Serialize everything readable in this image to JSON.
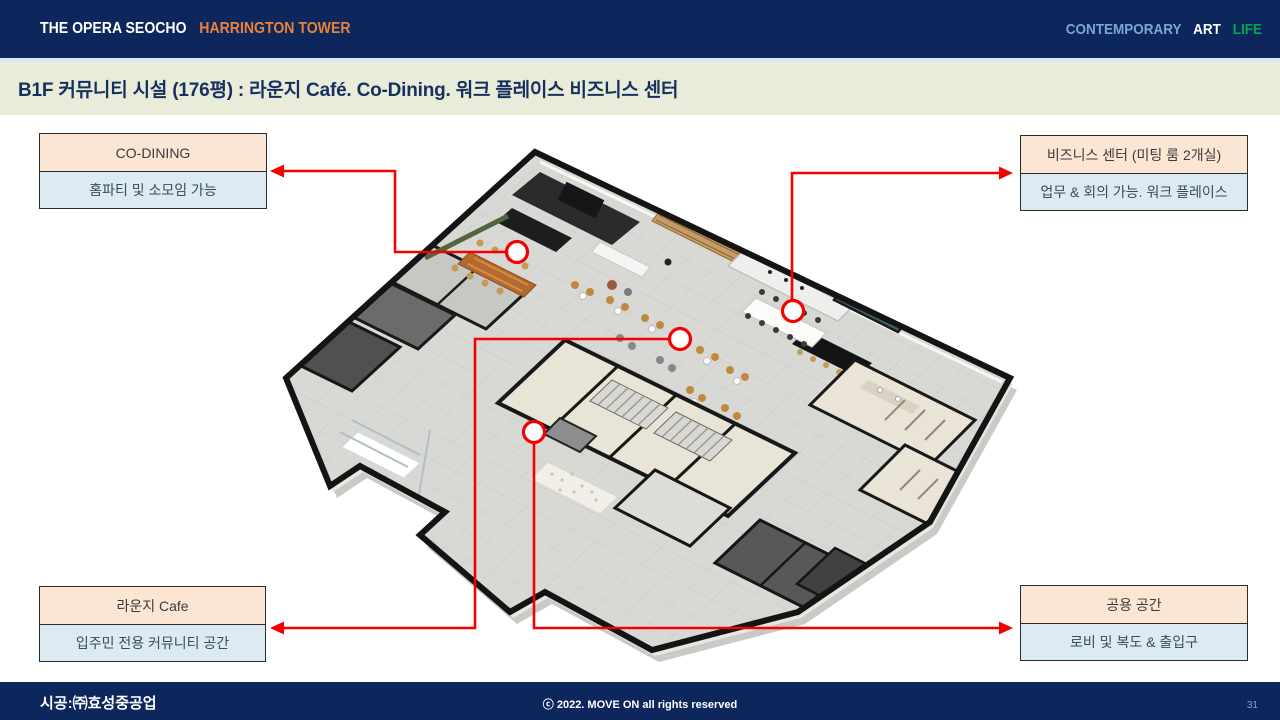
{
  "header": {
    "brand_primary": "THE OPERA SEOCHO",
    "brand_secondary": "HARRINGTON TOWER",
    "tagline_1": "CONTEMPORARY",
    "tagline_2": "ART",
    "tagline_3": "LIFE"
  },
  "title": {
    "text": "B1F 커뮤니티 시설 (176평) : 라운지 Café. Co-Dining. 워크 플레이스 비즈니스 센터"
  },
  "callouts": {
    "co_dining": {
      "title": "CO-DINING",
      "desc": "홈파티 및 소모임 가능"
    },
    "business": {
      "title": "비즈니스 센터 (미팅 룸 2개실)",
      "desc": "업무 & 회의 가능. 워크 플레이스"
    },
    "lounge": {
      "title": "라운지 Cafe",
      "desc": "입주민 전용 커뮤니티 공간"
    },
    "common": {
      "title": "공용 공간",
      "desc": "로비 및 복도 & 출입구"
    }
  },
  "footer": {
    "builder": "시공:㈜효성중공업",
    "copyright": "ⓒ 2022. MOVE ON all rights reserved",
    "page_number": "31"
  },
  "colors": {
    "navy": "#0d265c",
    "accent_red": "#f40000",
    "brand_orange": "#e8833a",
    "tagline_blue": "#7aa7d9",
    "tagline_green": "#00a651",
    "title_band_bg": "#e9ecd9",
    "callout_header_bg": "#fbe5d3",
    "callout_body_bg": "#dcebf3"
  }
}
